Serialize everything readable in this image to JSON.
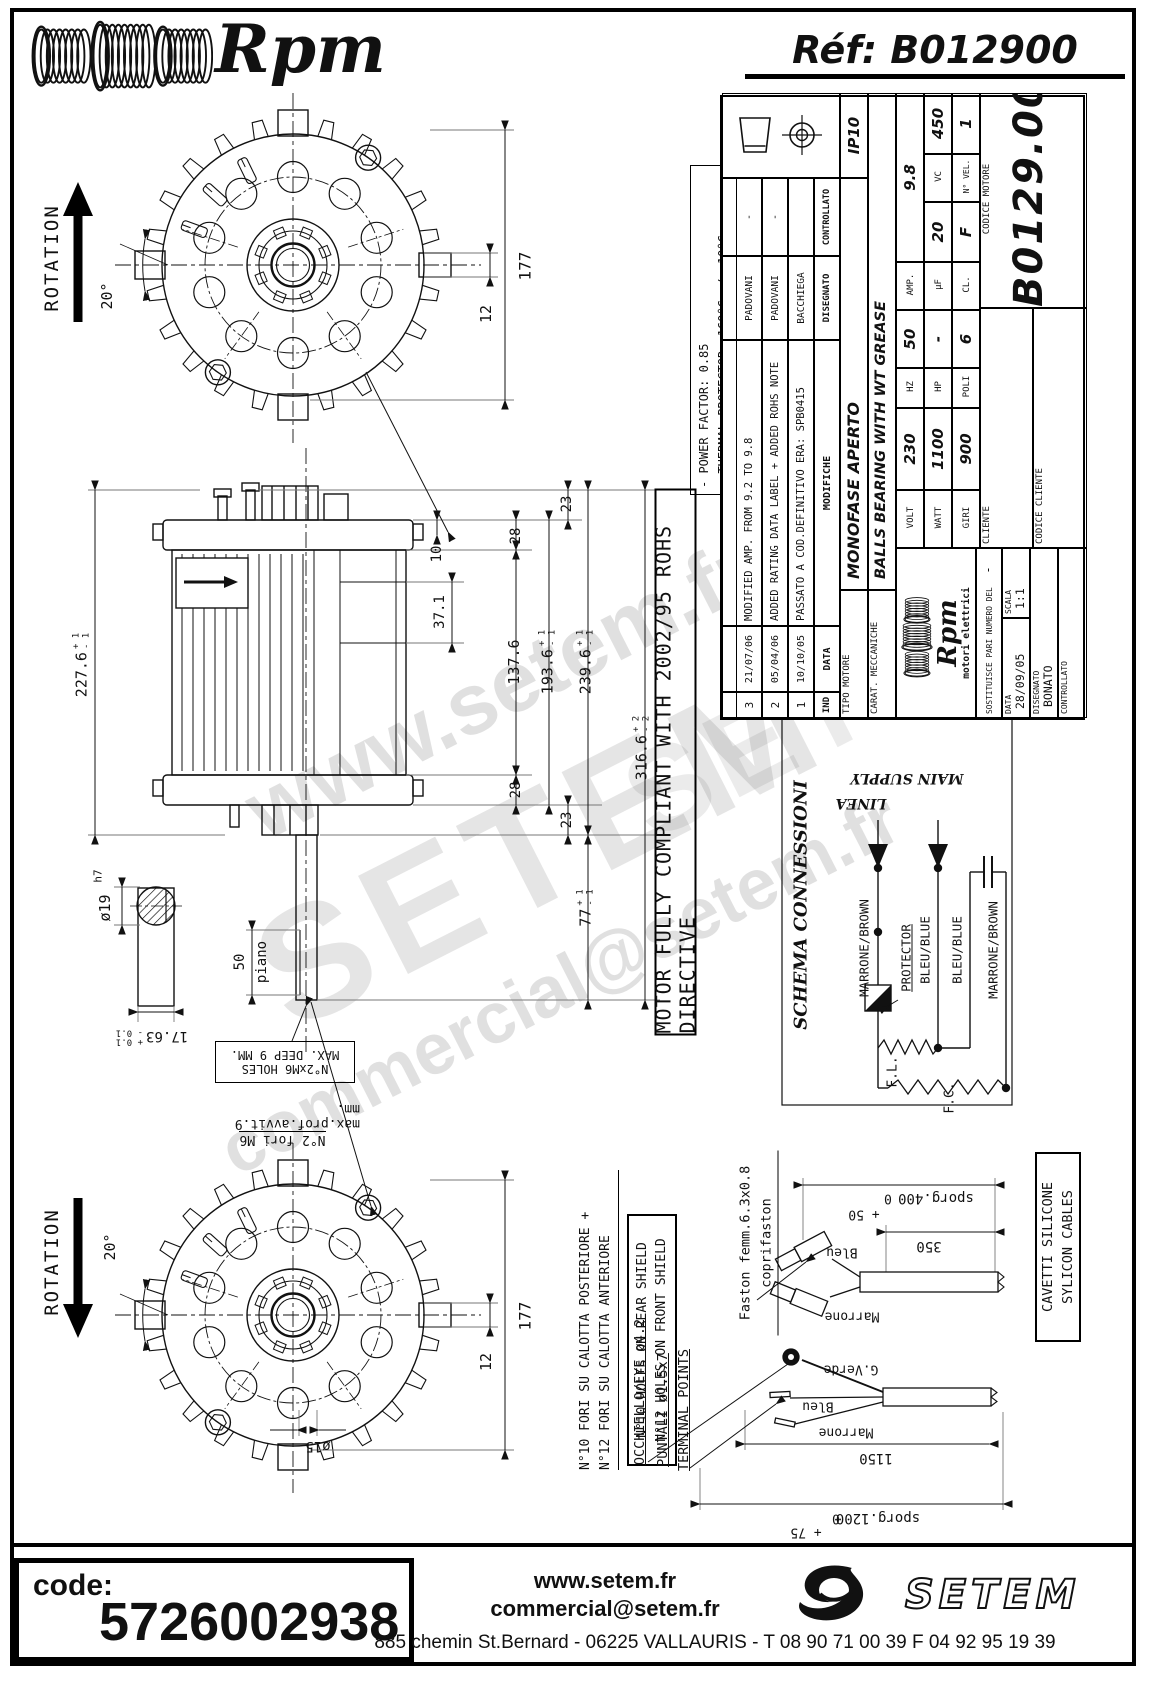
{
  "header": {
    "logo_text": "Rpm",
    "ref_label": "Réf:  B012900"
  },
  "watermarks": {
    "wm1": "www.setem.fr",
    "wm2": "SETEM",
    "wm3": "commercial@setem.fr",
    "wm4": ".fr",
    "wm5": "SETEM"
  },
  "notes": {
    "line1": "- POWER FACTOR: 0.85",
    "line2": "- THERMAL PROTECTOR: 160°C +/- 10°C",
    "line3": "- FLASH TEST DATA: 1800 VOLTS FOR 3 SEC",
    "line4": "- MOTOR MUST BE CONNECTED TO EARTH",
    "line5": "- RATING TO BE APPROVED BY THE CUSTOMER"
  },
  "rohs_banner": "MOTOR FULLY COMPLIANT WITH 2002/95 ROHS DIRECTIVE",
  "views": {
    "rotation_top": "ROTATION",
    "rotation_bottom": "ROTATION",
    "angle_top": "20°",
    "angle_bottom": "20°"
  },
  "dims": {
    "d177_top": "177",
    "d12_top": "12",
    "d177_bot": "177",
    "d12_bot": "12",
    "d2276": "227.6",
    "d2276_p": "+ 1",
    "d2276_m": "- 1",
    "d23t": "23",
    "d28t": "28",
    "d10": "10",
    "d371": "37.1",
    "d1376": "137.6",
    "d1936": "193.6",
    "d1936_p": "+ 1",
    "d1936_m": "- 1",
    "d2396": "239.6",
    "d2396_p": "+ 1",
    "d2396_m": "- 1",
    "d3166": "316.6",
    "d3166_p": "+ 2",
    "d3166_m": "- 2",
    "d28b": "28",
    "d23b": "23",
    "d77": "77",
    "d77_p": "+ 1",
    "d77_m": "- 1",
    "dia15": "ø15"
  },
  "shaft_detail": {
    "dia": "ø19",
    "fit": "h7",
    "width_val": "17.63",
    "width_tol_plus": "+ 0.1",
    "width_tol_minus": "- 0.1",
    "flat_len": "50",
    "flat_label": "piano",
    "holes_box_line1": "N°2xM6 HOLES",
    "holes_box_line2": "MAX. DEEP 9 MM.",
    "holes_it_line1": "N°2 fori M6",
    "holes_it_line2": "max.prof.avvit.9 mm."
  },
  "schema": {
    "title": "SCHEMA CONNESSIONI",
    "main_supply": "MAIN SUPPLY",
    "linea": "LINEA",
    "wire1": "MARRONE/BROWN",
    "protector": "PROTECTOR",
    "wire2": "BLEU/BLUE",
    "wire3": "BLEU/BLUE",
    "wire4": "MARRONE/BROWN",
    "fl": "F.L.",
    "fc": "F.C."
  },
  "holes_labels": {
    "fori_line1": "N°10 FORI SU CALOTTA POSTERIORE +",
    "fori_line2": "N°12 FORI SU CALOTTA ANTERIORE",
    "holes_line1": "N°10 HOLES ON REAR SHIELD",
    "holes_line2": "N°12 HOLES ON FRONT SHIELD",
    "eye": "OCCHIELLO/EYE ø4.2",
    "puntali": "PUNTALI ø1.5x7",
    "terminal": "TERMINAL POINTS",
    "faston_line1": "Faston femm.6.3x0.8",
    "faston_line2": "coprifaston"
  },
  "cables": {
    "box_line1": "CAVETTI SILICONE",
    "box_line2": "SYLICON CABLES",
    "a_wire1": "Bleu",
    "a_wire2": "Marrone",
    "a_sporg": "sporg.400",
    "a_sporg_zero": "0",
    "a_sporg_plus": "+ 50",
    "a_len": "350",
    "b_wire1": "G.Verde",
    "b_wire2": "Bleu",
    "b_wire3": "Marrone",
    "b_len": "1150",
    "b_sporg": "sporg.1200",
    "b_sporg_zero": "0",
    "b_sporg_plus": "+ 75"
  },
  "title_block": {
    "revisions": {
      "h_ind": "IND",
      "h_date": "DATA",
      "h_text": "MODIFICHE",
      "h_by": "DISEGNATO",
      "h_chk": "CONTROLLATO",
      "rows": [
        {
          "ind": "3",
          "date": "21/07/06",
          "text": "MODIFIED AMP. FROM 9.2 TO 9.8",
          "by": "PADOVANI",
          "chk": "-"
        },
        {
          "ind": "2",
          "date": "05/04/06",
          "text": "ADDED RATING DATA LABEL + ADDED ROHS NOTE",
          "by": "PADOVANI",
          "chk": "-"
        },
        {
          "ind": "1",
          "date": "10/10/05",
          "text": "PASSATO A COD.DEFINITIVO ERA: SPB0415",
          "by": "BACCHIEGA",
          "chk": ""
        }
      ]
    },
    "ip": "IP10",
    "tipo_label": "TIPO MOTORE",
    "tipo_value": "MONOFASE APERTO",
    "carat_label": "CARAT. MECCANICHE",
    "carat_value": "BALLS BEARING WITH WT GREASE",
    "volt_label": "VOLT",
    "volt": "230",
    "hz_label": "HZ",
    "hz": "50",
    "amp_label": "AMP.",
    "amp": "9.8",
    "watt_label": "WATT",
    "watt": "1100",
    "hp_label": "HP",
    "hp": "-",
    "uf_label": "µF",
    "uf": "20",
    "vc_label": "VC",
    "vc": "450",
    "giri_label": "GIRI",
    "giri": "900",
    "poli_label": "POLI",
    "poli": "6",
    "cl_label": "CL.",
    "cl": "F",
    "vel_label": "N° VEL.",
    "vel": "1",
    "brand": "Rpm",
    "brand_sub": "motori elettrici",
    "sost_label": "SOSTITUISCE PARI NUMERO DEL",
    "sost_value": "-",
    "data_label": "DATA",
    "data_value": "28/09/05",
    "scala_label": "SCALA",
    "scala_value": "1:1",
    "disegnato_label": "DISEGNATO",
    "disegnato_value": "BONATO",
    "controllato_label": "CONTROLLATO",
    "cliente_label": "CLIENTE",
    "codice_motore_label": "CODICE MOTORE",
    "codice_motore": "B0129.00",
    "codice_cliente_label": "CODICE CLIENTE"
  },
  "footer": {
    "code_label": "code:",
    "code_value": "5726002938",
    "site": "www.setem.fr",
    "email": "commercial@setem.fr",
    "address": "885 chemin St.Bernard  -  06225 VALLAURIS  -  T 08 90 71 00 39   F 04 92 95 19 39",
    "brand": "SETEM"
  }
}
